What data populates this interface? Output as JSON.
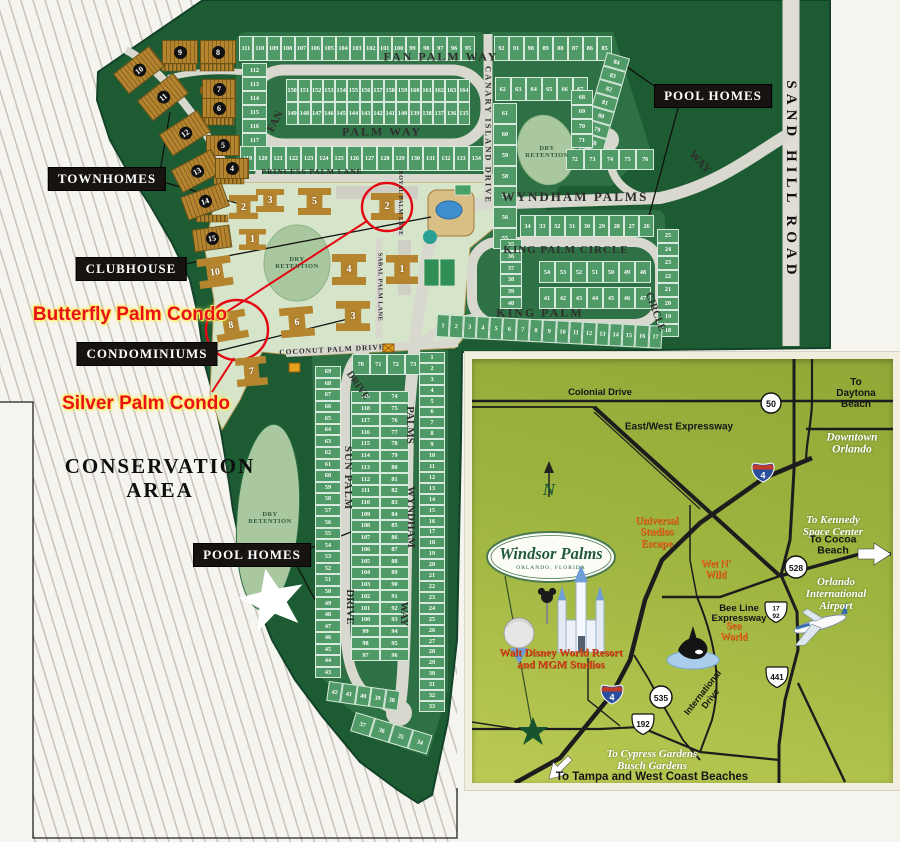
{
  "site": {
    "boxes": {
      "townhomes": "TOWNHOMES",
      "clubhouse": "CLUBHOUSE",
      "condominiums": "CONDOMINIUMS",
      "pool_homes_ne": "POOL HOMES",
      "pool_homes_sw": "POOL HOMES"
    },
    "area_labels": {
      "conservation": "CONSERVATION\nAREA",
      "dry_retention": "DRY\nRETENTION"
    },
    "red_annotations": {
      "butterfly": "Butterfly Palm Condo",
      "silver": "Silver Palm Condo",
      "color": "#e81019"
    },
    "streets": {
      "fan_palm_top": "FAN   PALM   WAY",
      "fan_rot": "FAN",
      "palm_way": "PALM   WAY",
      "princess": "PRINCESS PALM LANE",
      "canary": "CANARY ISLAND DRIVE",
      "wyndham_main": "WYNDHAM   PALMS",
      "way_ne": "WAY",
      "sand_hill": "SAND  HILL  ROAD",
      "king_palm_circle": "KING  PALM  CIRCLE",
      "king_palm": "KING   PALM",
      "circle_rot": "CIRCLE",
      "coconut": "COCONUT PALM DRIVE",
      "sabal": "SABAL PALM LANE",
      "royal": "ROYAL PALM LANE",
      "sun_palm": "SUN  PALM",
      "drive_top": "DRIVE",
      "drive_low": "DRIVE",
      "palms_s": "PALMS",
      "wyndham_s": "WYNDHAM",
      "way_s": "WAY"
    },
    "lot_strips": {
      "fp_top": [
        "111",
        "110",
        "109",
        "108",
        "107",
        "106",
        "105",
        "104",
        "103",
        "102",
        "101",
        "100",
        "99",
        "98",
        "97",
        "96",
        "95"
      ],
      "fp_west": [
        "112",
        "113",
        "114",
        "115",
        "116",
        "117",
        "118"
      ],
      "fp_inner_top": [
        "150",
        "151",
        "152",
        "153",
        "154",
        "155",
        "156",
        "157",
        "158",
        "159",
        "160",
        "161",
        "162",
        "163",
        "164"
      ],
      "fp_inner_bot": [
        "149",
        "148",
        "147",
        "146",
        "145",
        "144",
        "143",
        "142",
        "141",
        "140",
        "139",
        "138",
        "137",
        "136",
        "135"
      ],
      "fp_bot": [
        "119",
        "120",
        "121",
        "122",
        "123",
        "124",
        "125",
        "126",
        "127",
        "128",
        "129",
        "130",
        "131",
        "132",
        "133",
        "134"
      ],
      "ne_top": [
        "92",
        "91",
        "90",
        "89",
        "88",
        "87",
        "86",
        "85"
      ],
      "ne_row2": [
        "62",
        "63",
        "64",
        "65",
        "66",
        "67"
      ],
      "ne_west": [
        "61",
        "60",
        "59",
        "58",
        "57",
        "56",
        "55"
      ],
      "ne_outer": [
        "84",
        "83",
        "82",
        "81",
        "80",
        "79",
        "78",
        "77"
      ],
      "ne_inner": [
        "68",
        "69",
        "70",
        "71"
      ],
      "ne_arc": [
        "72",
        "73",
        "74",
        "75",
        "76"
      ],
      "kp_top": [
        "34",
        "33",
        "32",
        "31",
        "30",
        "29",
        "28",
        "27",
        "26"
      ],
      "kp_west": [
        "35",
        "36",
        "37",
        "38",
        "39",
        "40"
      ],
      "kp_east": [
        "25",
        "24",
        "23",
        "22",
        "21",
        "20",
        "19",
        "18"
      ],
      "kp_inner_top": [
        "54",
        "53",
        "52",
        "51",
        "50",
        "49",
        "48"
      ],
      "kp_inner_bot": [
        "41",
        "42",
        "43",
        "44",
        "45",
        "46",
        "47"
      ],
      "kp_bot": [
        "1",
        "2",
        "3",
        "4",
        "5",
        "6",
        "7",
        "8",
        "9",
        "10",
        "11",
        "12",
        "13",
        "14",
        "15",
        "16",
        "17"
      ],
      "s_top": [
        "70",
        "71",
        "72",
        "73"
      ],
      "s_west": [
        "69",
        "68",
        "67",
        "66",
        "65",
        "64",
        "63",
        "62",
        "61",
        "60",
        "59",
        "58",
        "57",
        "56",
        "55",
        "54",
        "53",
        "52",
        "51",
        "50",
        "49",
        "48",
        "47",
        "46",
        "45",
        "44",
        "43"
      ],
      "s_arc1": [
        "42",
        "41",
        "40",
        "39",
        "38"
      ],
      "s_arc2": [
        "37",
        "36",
        "35",
        "34"
      ],
      "s_mid_w": [
        "119",
        "118",
        "117",
        "116",
        "115",
        "114",
        "113",
        "112",
        "111",
        "110",
        "109",
        "108",
        "107",
        "106",
        "105",
        "104",
        "103",
        "102",
        "101",
        "100",
        "99",
        "98",
        "97"
      ],
      "s_mid_e": [
        "74",
        "75",
        "76",
        "77",
        "78",
        "79",
        "80",
        "81",
        "82",
        "83",
        "84",
        "85",
        "86",
        "87",
        "88",
        "89",
        "90",
        "91",
        "92",
        "93",
        "94",
        "95",
        "96"
      ],
      "s_east": [
        "1",
        "2",
        "3",
        "4",
        "5",
        "6",
        "7",
        "8",
        "9",
        "10",
        "11",
        "12",
        "13",
        "14",
        "15",
        "16",
        "17",
        "18",
        "19",
        "20",
        "21",
        "22",
        "23",
        "24",
        "25",
        "26",
        "27",
        "28",
        "29",
        "30",
        "31",
        "32",
        "33"
      ]
    },
    "townhome_numbers": [
      "9",
      "8",
      "10",
      "7",
      "11",
      "6",
      "12",
      "5",
      "13",
      "4",
      "14",
      "15"
    ],
    "condo_numbers": [
      "2",
      "3",
      "5",
      "2",
      "1",
      "10",
      "4",
      "1",
      "6",
      "3",
      "8",
      "7"
    ]
  },
  "inset": {
    "logo": {
      "name": "Windsor Palms",
      "subtitle": "ORLANDO, FLORIDA"
    },
    "labels": {
      "colonial": "Colonial Drive",
      "daytona": "To Daytona Beach",
      "expressway": "East/West Expressway",
      "downtown": "Downtown\nOrlando",
      "kennedy": "To Kennedy\nSpace Center",
      "cocoa": "To Cocoa Beach",
      "universal": "Universal\nStudios\nEscape",
      "wet_n_wild": "Wet N'\nWild",
      "beeline": "Bee Line\nExpressway",
      "seaworld": "Sea\nWorld",
      "airport": "Orlando\nInternational\nAirport",
      "intl_drive": "International\nDrive",
      "disney": "Walt Disney World Resort\nand MGM Studios",
      "cypress": "To Cypress Gardens\nBusch Gardens",
      "tampa": "To Tampa and West Coast Beaches",
      "north": "N"
    },
    "shields": {
      "i4": "4",
      "us50": "50",
      "sr528": "528",
      "us17": "17",
      "us92": "92",
      "us441": "441",
      "sr535": "535",
      "us192": "192"
    },
    "colors": {
      "orange": "#e2701f",
      "road": "#1d1d1d",
      "star_green": "#16532e"
    }
  }
}
